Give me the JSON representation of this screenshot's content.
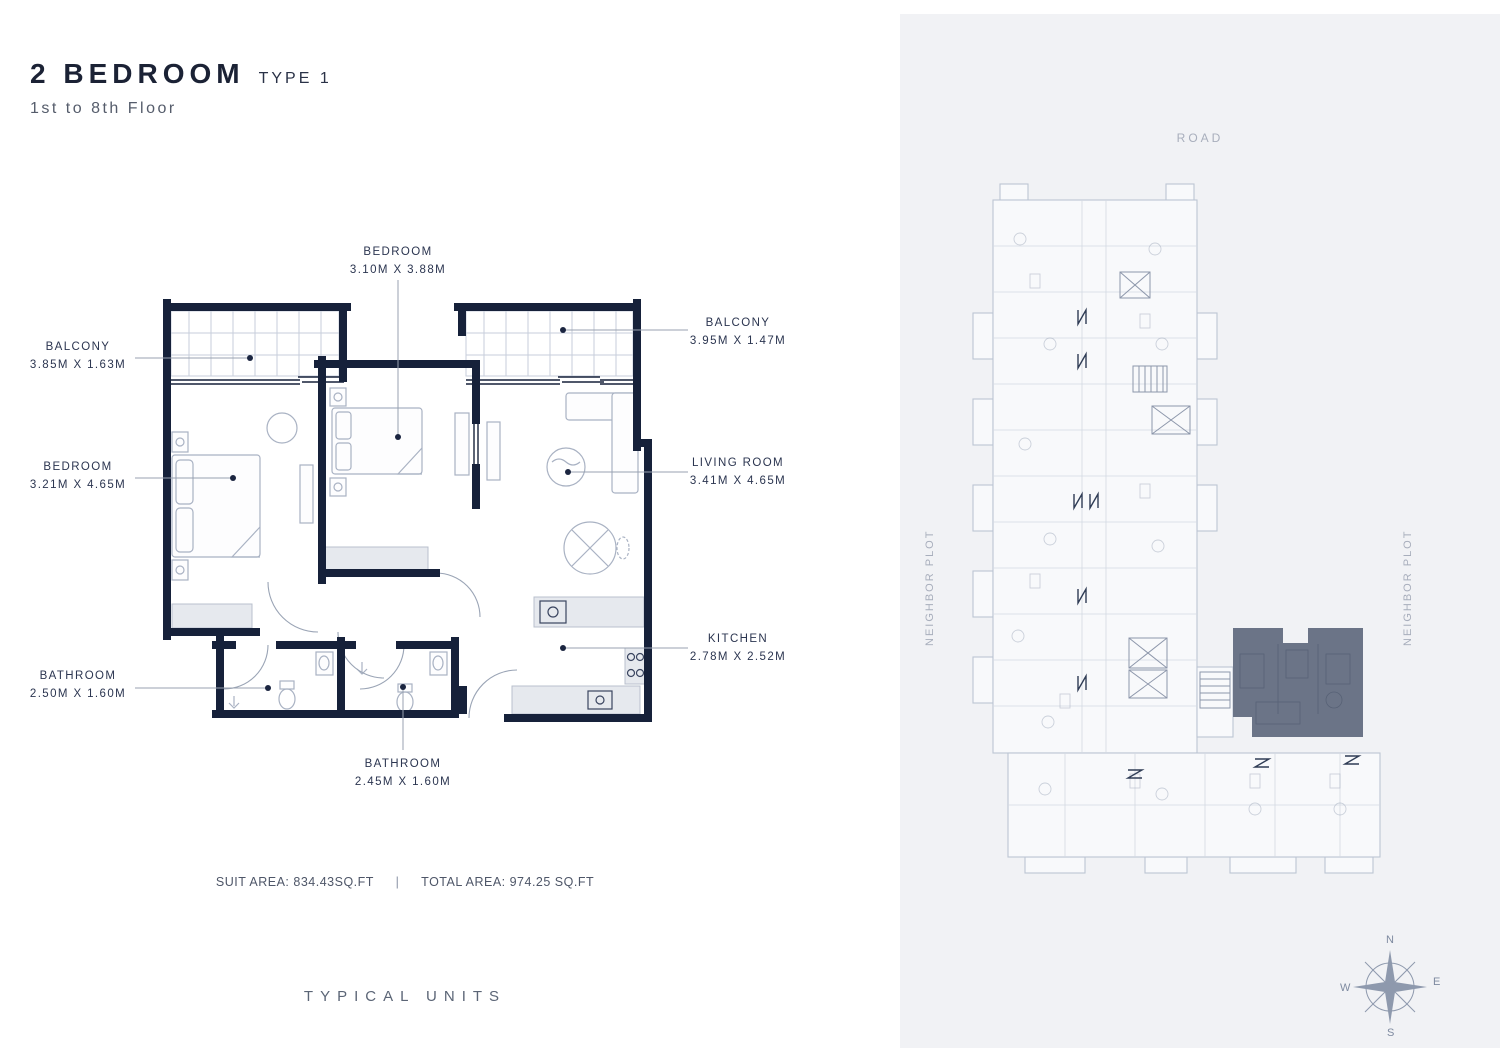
{
  "header": {
    "title": "2 BEDROOM",
    "type": "TYPE 1",
    "floors": "1st to 8th Floor"
  },
  "unit_plan": {
    "labels": [
      {
        "id": "bedroom-top",
        "name": "BEDROOM",
        "dims": "3.10M X 3.88M"
      },
      {
        "id": "balcony-right",
        "name": "BALCONY",
        "dims": "3.95M X 1.47M"
      },
      {
        "id": "balcony-left",
        "name": "BALCONY",
        "dims": "3.85M X 1.63M"
      },
      {
        "id": "bedroom-left",
        "name": "BEDROOM",
        "dims": "3.21M X 4.65M"
      },
      {
        "id": "living-room",
        "name": "LIVING ROOM",
        "dims": "3.41M X 4.65M"
      },
      {
        "id": "kitchen",
        "name": "KITCHEN",
        "dims": "2.78M X 2.52M"
      },
      {
        "id": "bathroom-left",
        "name": "BATHROOM",
        "dims": "2.50M X 1.60M"
      },
      {
        "id": "bathroom-bottom",
        "name": "BATHROOM",
        "dims": "2.45M X 1.60M"
      }
    ],
    "areas": {
      "suit": "SUIT AREA: 834.43SQ.FT",
      "separator": "|",
      "total": "TOTAL AREA: 974.25 SQ.FT"
    }
  },
  "footer": {
    "left": "TYPICAL UNITS",
    "right": "FLOOR PLATE"
  },
  "floor_plate": {
    "road": "ROAD",
    "neighbor_left": "NEIGHBOR PLOT",
    "neighbor_right": "NEIGHBOR PLOT"
  },
  "compass": {
    "n": "N",
    "e": "E",
    "s": "S",
    "w": "W"
  },
  "colors": {
    "wall": "#16213a",
    "highlight": "#6b7487",
    "panel_bg": "#f1f2f5",
    "label_text": "#2b3550"
  }
}
